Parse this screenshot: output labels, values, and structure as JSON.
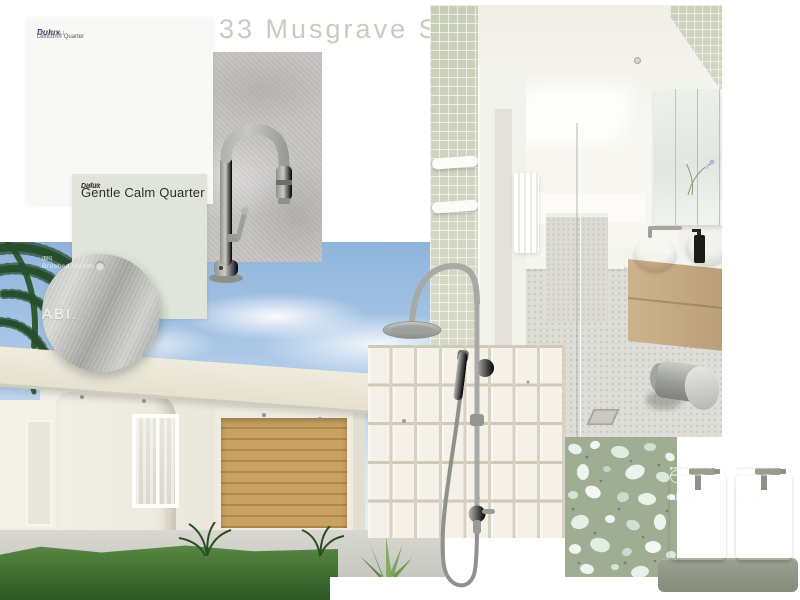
{
  "board": {
    "title": "33 Musgrave St.",
    "house_number": "33"
  },
  "swatches": {
    "lexicon": {
      "brand": "Dulux",
      "name": "Lexicon® Quarter",
      "code": "SW1 A018 1"
    },
    "gentle_calm": {
      "brand": "Dulux",
      "code": "A1151",
      "name": "Gentle Calm Quarter"
    }
  },
  "finish_sample": {
    "brand": "ABI.",
    "finish": "Brushed Nickel",
    "note": "(BN)"
  },
  "alive": {
    "brand": "al.ive",
    "sub": "BODY",
    "collection": "EARTH COLLECTION",
    "variant": "GREEN PEPPER & LOTUS",
    "left_type": "NATURAL HAND & BODY LOTION",
    "right_type": "NATURAL HAND & BODY WASH"
  },
  "palette": {
    "brushed_nickel": "#b2b4b0",
    "lexicon_white": "#f8f9f7",
    "gentle_calm_green": "#e0e4da",
    "concrete_grey": "#c6c4c2",
    "terrazzo_green": "#9fad92",
    "bottle_sage": "#a4a896",
    "timber": "#c79e5f",
    "sky_blue": "#a9c7e4",
    "lawn_green": "#47763a",
    "title_grey": "#c9cac1"
  }
}
